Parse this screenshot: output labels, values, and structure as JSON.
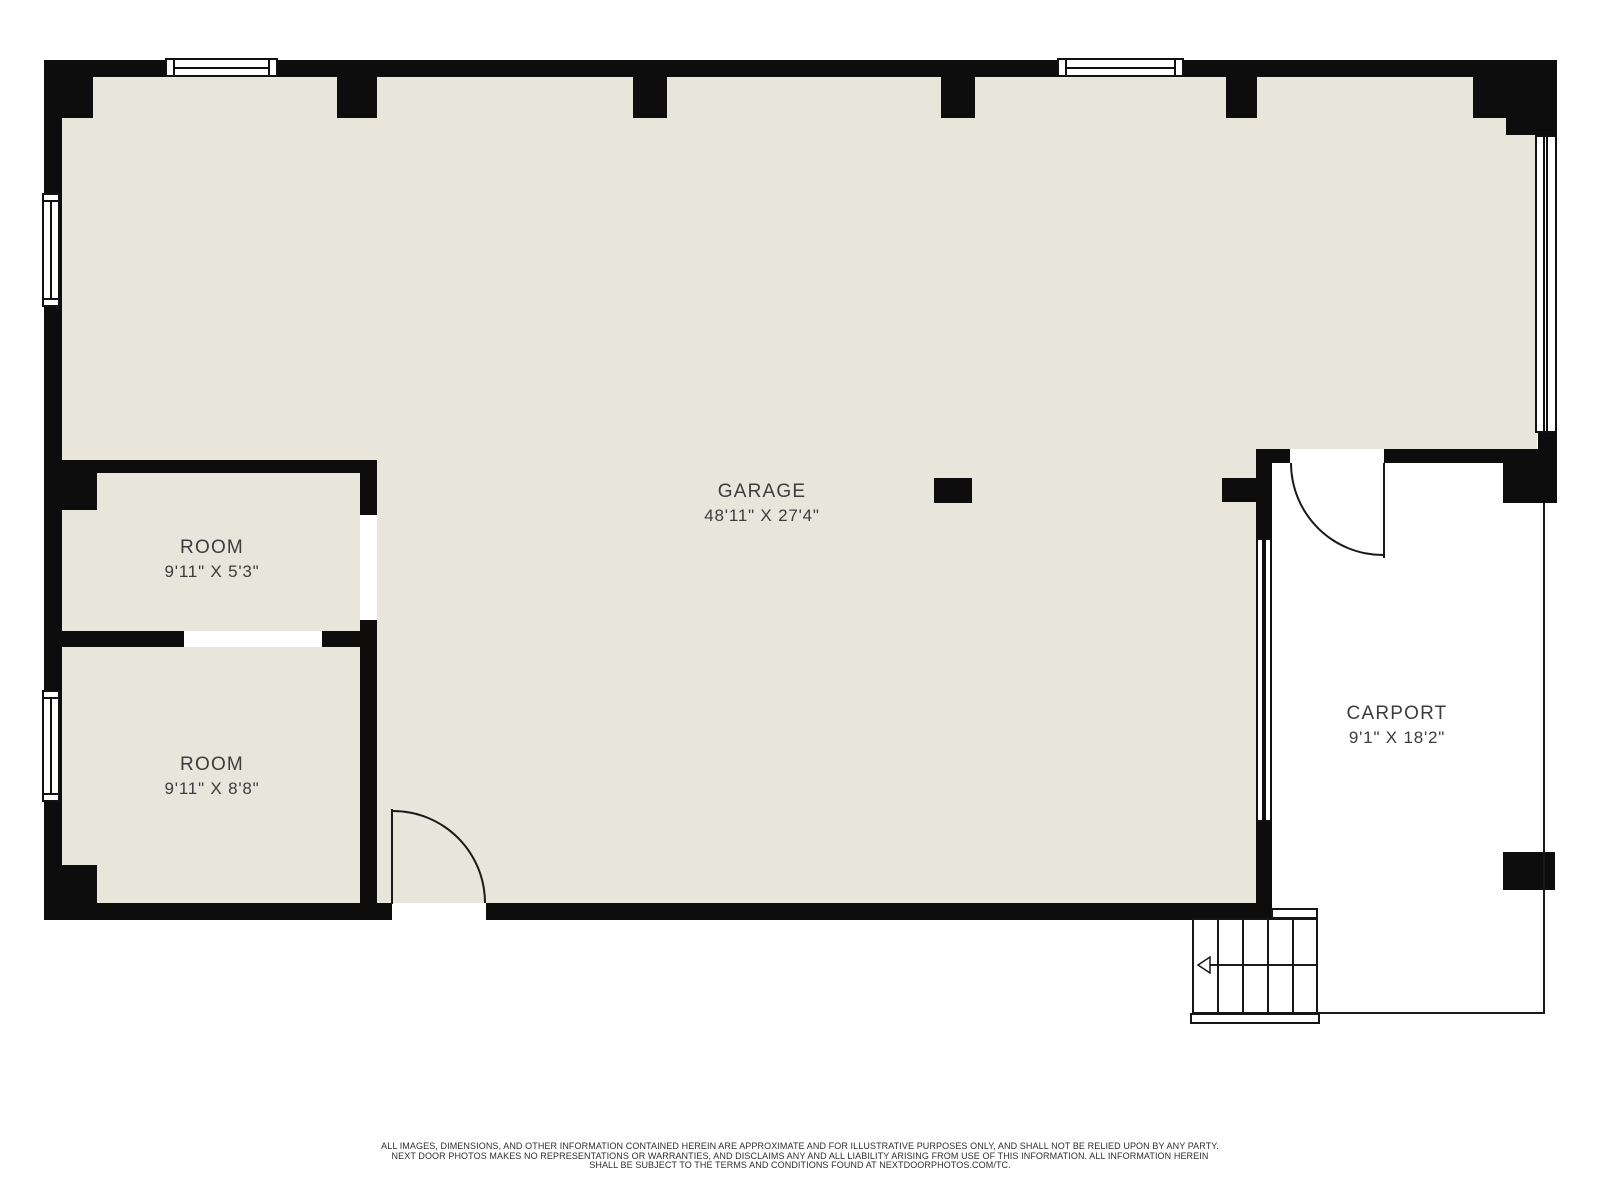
{
  "plan": {
    "title": "Garage floor plan",
    "rooms": [
      {
        "name": "GARAGE",
        "dims": "48'11\" X 27'4\""
      },
      {
        "name": "ROOM",
        "dims": "9'11\" X 5'3\""
      },
      {
        "name": "ROOM",
        "dims": "9'11\" X 8'8\""
      },
      {
        "name": "CARPORT",
        "dims": "9'1\" X 18'2\""
      }
    ],
    "icons": {
      "stairs_direction": "left-arrow"
    },
    "colors": {
      "floor": "#E8E6DB",
      "wall": "#0D0D0D",
      "label_text": "#3C3C3C",
      "footer_text": "#2E2E2E",
      "background": "#FFFFFF"
    },
    "footer": {
      "line1": "ALL IMAGES, DIMENSIONS, AND OTHER INFORMATION CONTAINED HEREIN ARE APPROXIMATE AND FOR ILLUSTRATIVE PURPOSES ONLY, AND SHALL NOT BE RELIED UPON BY ANY PARTY.",
      "line2": "NEXT DOOR PHOTOS MAKES NO REPRESENTATIONS OR WARRANTIES, AND DISCLAIMS ANY AND ALL LIABILITY ARISING FROM USE OF THIS INFORMATION. ALL INFORMATION HEREIN",
      "line3": "SHALL BE SUBJECT TO THE TERMS AND CONDITIONS FOUND AT NEXTDOORPHOTOS.COM/TC."
    }
  }
}
